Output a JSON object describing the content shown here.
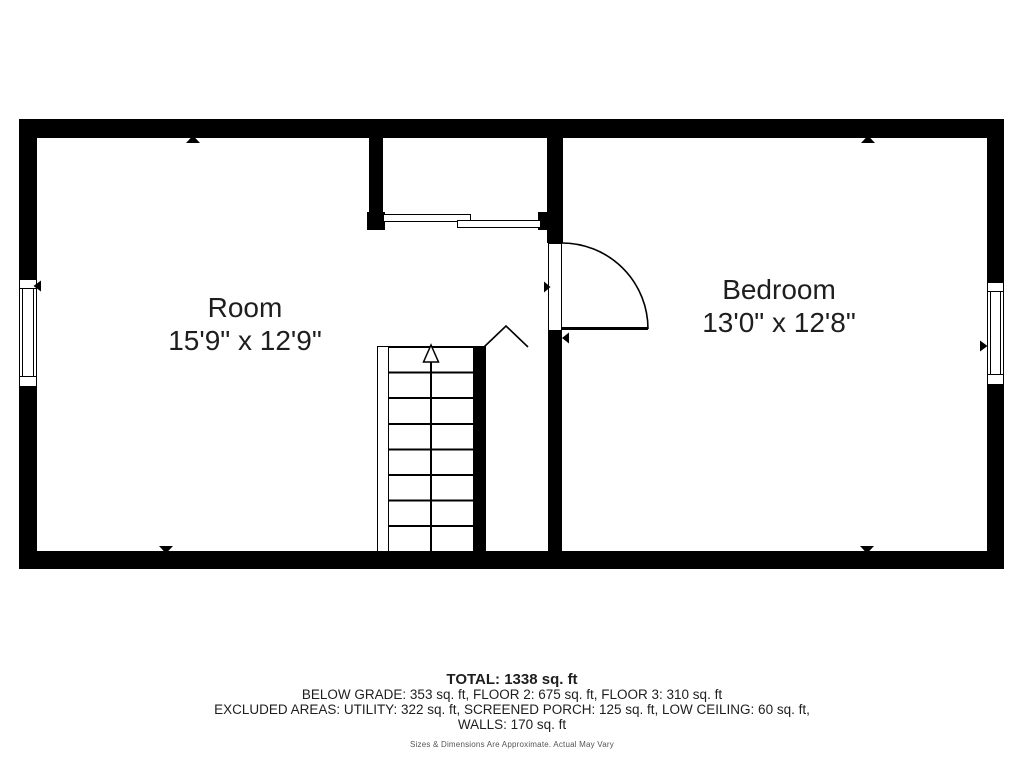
{
  "plan": {
    "rooms": [
      {
        "name": "Room",
        "dimensions": "15'9\" x 12'9\""
      },
      {
        "name": "Bedroom",
        "dimensions": "13'0\" x 12'8\""
      }
    ]
  },
  "footer": {
    "total": "TOTAL: 1338 sq. ft",
    "floors": "BELOW GRADE: 353 sq. ft, FLOOR 2: 675 sq. ft, FLOOR 3: 310 sq. ft",
    "excluded": "EXCLUDED AREAS: UTILITY: 322 sq. ft, SCREENED PORCH: 125 sq. ft, LOW CEILING: 60 sq. ft,",
    "excluded2": "WALLS: 170 sq. ft",
    "disclaimer": "Sizes & Dimensions Are Approximate. Actual May Vary"
  },
  "colors": {
    "wall": "#000000",
    "background": "#ffffff",
    "text": "#1e1e1e",
    "disclaimer_text": "#555555"
  }
}
